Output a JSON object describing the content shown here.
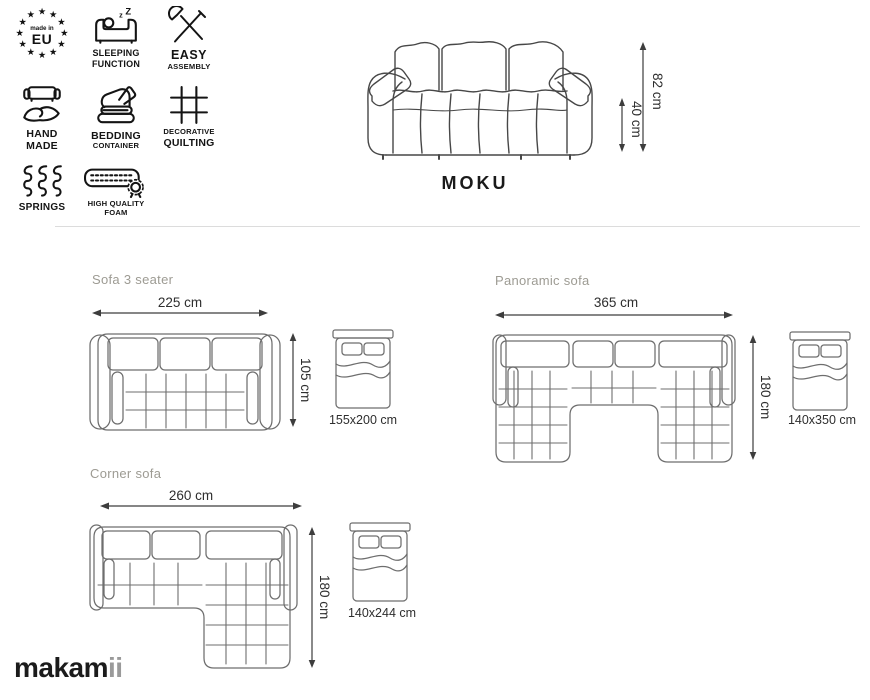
{
  "brand": {
    "name_dark": "makam",
    "name_light": "ii"
  },
  "product": {
    "name": "MOKU"
  },
  "front_view": {
    "total_height": "82 cm",
    "seat_height": "40 cm"
  },
  "features": [
    {
      "icon": "made-in-eu-stars-icon",
      "line1": "made in",
      "line2": "EU"
    },
    {
      "icon": "sleeping-function-icon",
      "line1": "SLEEPING",
      "line2": "FUNCTION"
    },
    {
      "icon": "easy-assembly-icon",
      "line1": "EASY",
      "line2": "ASSEMBLY"
    },
    {
      "icon": "hand-made-icon",
      "line1": "HAND",
      "line2": "MADE"
    },
    {
      "icon": "bedding-container-icon",
      "line1": "BEDDING",
      "line2": "CONTAINER"
    },
    {
      "icon": "decorative-quilting-icon",
      "line1": "DECORATIVE",
      "line2": "QUILTING"
    },
    {
      "icon": "springs-icon",
      "line1": "SPRINGS",
      "line2": ""
    },
    {
      "icon": "high-quality-foam-icon",
      "line1": "HIGH QUALITY",
      "line2": "FOAM"
    }
  ],
  "sections": {
    "sofa3": {
      "title": "Sofa 3 seater",
      "width": "225 cm",
      "depth": "105 cm",
      "bed_size": "155x200 cm"
    },
    "panoramic": {
      "title": "Panoramic sofa",
      "width": "365 cm",
      "depth": "180 cm",
      "bed_size": "140x350 cm"
    },
    "corner": {
      "title": "Corner sofa",
      "width": "260 cm",
      "depth": "180 cm",
      "bed_size": "140x244 cm"
    }
  },
  "colors": {
    "title_gray": "#9d9b93",
    "line_gray": "#6e6e6e",
    "dark_line": "#474747",
    "divider": "#dcdcdc",
    "logo_light": "#9a9a9a"
  }
}
